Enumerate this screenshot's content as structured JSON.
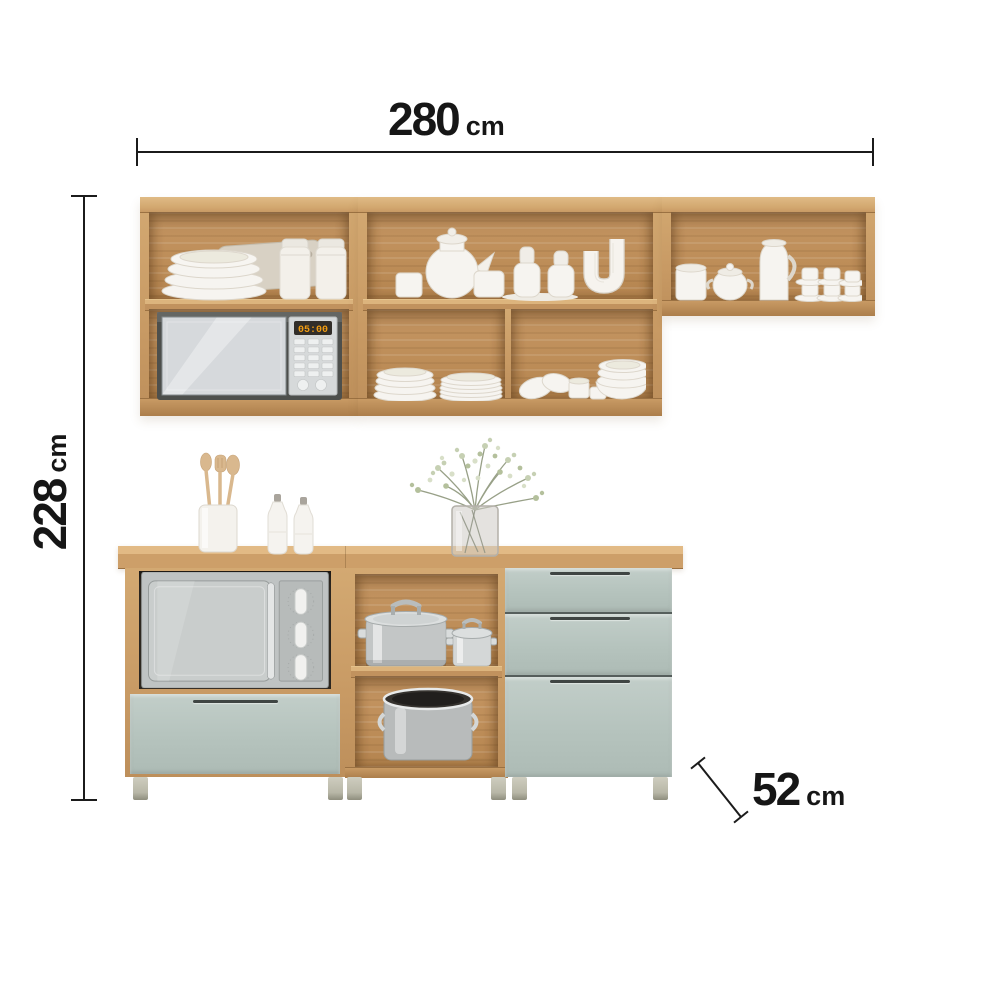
{
  "annotations": {
    "width": {
      "value": "280",
      "unit": "cm"
    },
    "height": {
      "value": "228",
      "unit": "cm"
    },
    "depth": {
      "value": "52",
      "unit": "cm"
    }
  },
  "appliances": {
    "microwave_display": "05:00"
  },
  "colors": {
    "background": "#ffffff",
    "annotation_ink": "#1b1b1b",
    "wood": "#c89a64",
    "wood_light": "#dcb47d",
    "wood_dark": "#a87c4c",
    "cabinet_interior": "#bd8d58",
    "door_green": "#b5c3bd",
    "appliance_silver": "#c3c7c6",
    "microwave_display_amber": "#f09c12",
    "leg_gray": "#c9c8ba"
  },
  "scene_objects": [
    "wall cabinet with bowls, cutting board, jars and microwave",
    "wall cabinet with tea set, shakers, vase, plates and bowls",
    "wall cabinet with mugs, pitcher and stacked coffee cups",
    "base cabinet with built-in grill oven and drawer",
    "open base shelf with steel pots and stockpot",
    "base cabinet with three drawers",
    "utensil holder with wooden utensils",
    "two ceramic bottles",
    "glass vase with greenery"
  ]
}
